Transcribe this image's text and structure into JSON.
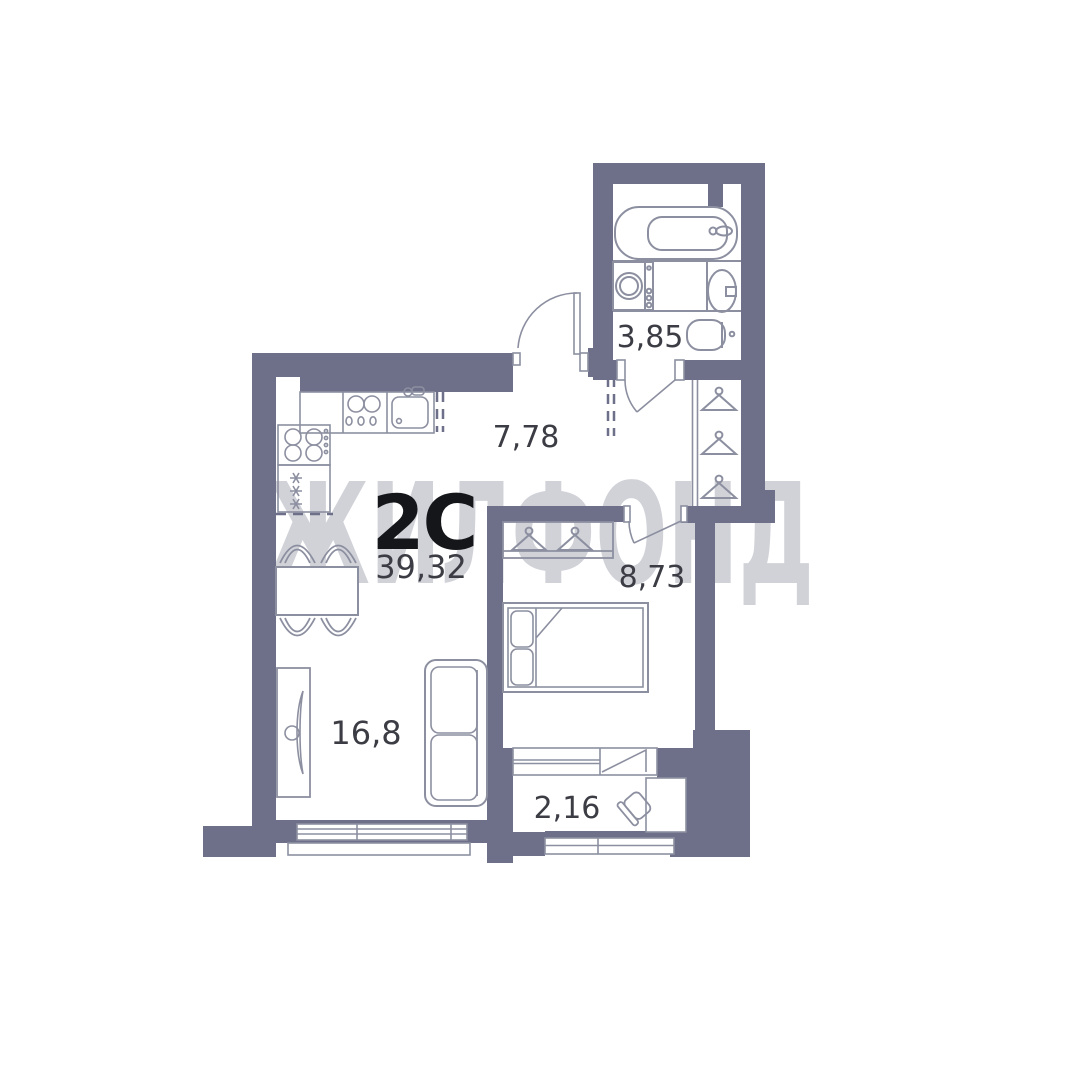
{
  "floorplan": {
    "watermark": "ЖИЛФОНД",
    "apartment": {
      "type": "2С",
      "total_area": "39,32"
    },
    "rooms": {
      "hallway": "7,78",
      "bathroom": "3,85",
      "bedroom": "8,73",
      "living_kitchen": "16,8",
      "balcony": "2,16"
    },
    "colors": {
      "wall": "#6e7089",
      "furniture_line": "#8c8fa0",
      "watermark": "#d1d2d8",
      "room_label": "#3b3c44",
      "type_label": "#15161a"
    }
  }
}
